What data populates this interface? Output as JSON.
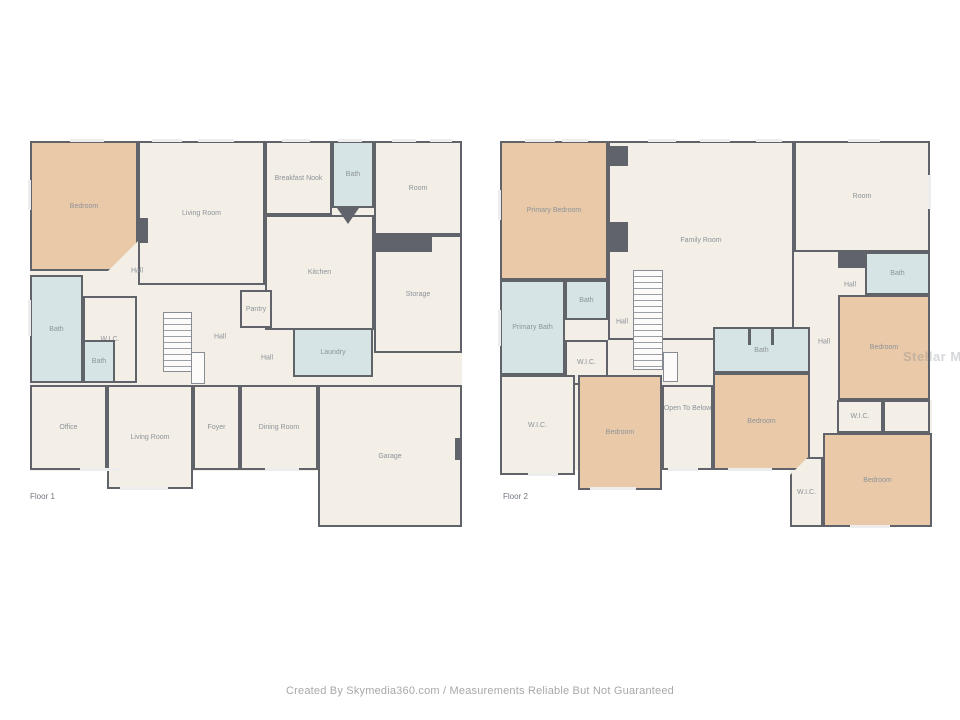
{
  "footer": {
    "credit": "Created By Skymedia360.com / Measurements Reliable But Not Guaranteed"
  },
  "watermark": {
    "text": "Stellar MLS"
  },
  "palette": {
    "floor": "#f3eee6",
    "bedroom": "#e9c9a7",
    "bath": "#d6e4e6",
    "wall": "#60646a",
    "label": "#8d939b",
    "window": "#ededed"
  },
  "floors": [
    {
      "label": "Floor 1",
      "label_pos": {
        "x": 30,
        "y": 492
      },
      "base": [
        {
          "x": 30,
          "y": 141,
          "w": 432,
          "h": 246
        },
        {
          "x": 30,
          "y": 385,
          "w": 288,
          "h": 86
        },
        {
          "x": 318,
          "y": 385,
          "w": 144,
          "h": 142
        }
      ],
      "rooms": [
        {
          "name": "Living Room",
          "type": "floor",
          "x": 138,
          "y": 141,
          "w": 127,
          "h": 144
        },
        {
          "name": "Breakfast Nook",
          "type": "floor",
          "x": 265,
          "y": 141,
          "w": 67,
          "h": 74
        },
        {
          "name": "Bath",
          "type": "bath",
          "x": 332,
          "y": 141,
          "w": 42,
          "h": 67
        },
        {
          "name": "Room",
          "type": "floor",
          "x": 374,
          "y": 141,
          "w": 88,
          "h": 94
        },
        {
          "name": "Hall",
          "type": "floor",
          "x": 332,
          "y": 208,
          "w": 42,
          "h": 44,
          "noborder": true
        },
        {
          "name": "Kitchen",
          "type": "floor",
          "x": 265,
          "y": 215,
          "w": 109,
          "h": 115
        },
        {
          "name": "Storage",
          "type": "floor",
          "x": 374,
          "y": 235,
          "w": 88,
          "h": 118
        },
        {
          "name": "Bedroom",
          "type": "bedroom",
          "x": 30,
          "y": 141,
          "w": 108,
          "h": 130,
          "clip": "br"
        },
        {
          "name": "Bath",
          "type": "bath",
          "x": 30,
          "y": 275,
          "w": 53,
          "h": 108
        },
        {
          "name": "W.I.C.",
          "type": "floor",
          "x": 83,
          "y": 296,
          "w": 54,
          "h": 87
        },
        {
          "name": "Bath",
          "type": "bath",
          "x": 83,
          "y": 340,
          "w": 32,
          "h": 43
        },
        {
          "name": "Pantry",
          "type": "floor",
          "x": 240,
          "y": 290,
          "w": 32,
          "h": 38
        },
        {
          "name": "Laundry",
          "type": "bath",
          "x": 293,
          "y": 328,
          "w": 80,
          "h": 49
        },
        {
          "name": "Office",
          "type": "floor",
          "x": 30,
          "y": 385,
          "w": 77,
          "h": 85
        },
        {
          "name": "Living Room",
          "type": "floor",
          "x": 107,
          "y": 385,
          "w": 86,
          "h": 104
        },
        {
          "name": "Foyer",
          "type": "floor",
          "x": 193,
          "y": 385,
          "w": 47,
          "h": 85
        },
        {
          "name": "Dining Room",
          "type": "floor",
          "x": 240,
          "y": 385,
          "w": 78,
          "h": 85
        },
        {
          "name": "Garage",
          "type": "floor",
          "x": 318,
          "y": 385,
          "w": 144,
          "h": 142
        }
      ],
      "labels": [
        {
          "text": "Hall",
          "x": 137,
          "y": 271
        },
        {
          "text": "Hall",
          "x": 220,
          "y": 337
        },
        {
          "text": "Hall",
          "x": 267,
          "y": 358
        }
      ],
      "wall_blocks": [
        {
          "x": 138,
          "y": 218,
          "w": 10,
          "h": 25
        },
        {
          "x": 374,
          "y": 237,
          "w": 58,
          "h": 15
        },
        {
          "x": 455,
          "y": 438,
          "w": 7,
          "h": 22
        },
        {
          "x": 337,
          "y": 208,
          "w": 22,
          "h": 16,
          "shape": "tri"
        }
      ],
      "stairs": [
        {
          "x": 163,
          "y": 312,
          "w": 29,
          "h": 60
        }
      ],
      "landings": [
        {
          "x": 191,
          "y": 352,
          "w": 14,
          "h": 32
        }
      ],
      "windows": [
        {
          "x": 70,
          "y": 139,
          "w": 34,
          "h": 3
        },
        {
          "x": 152,
          "y": 139,
          "w": 30,
          "h": 3
        },
        {
          "x": 198,
          "y": 139,
          "w": 36,
          "h": 3
        },
        {
          "x": 282,
          "y": 139,
          "w": 28,
          "h": 3
        },
        {
          "x": 338,
          "y": 139,
          "w": 24,
          "h": 3
        },
        {
          "x": 392,
          "y": 139,
          "w": 24,
          "h": 3
        },
        {
          "x": 430,
          "y": 139,
          "w": 22,
          "h": 3
        },
        {
          "x": 28,
          "y": 180,
          "w": 3,
          "h": 30
        },
        {
          "x": 28,
          "y": 300,
          "w": 3,
          "h": 36
        },
        {
          "x": 80,
          "y": 468,
          "w": 40,
          "h": 3
        },
        {
          "x": 120,
          "y": 487,
          "w": 48,
          "h": 3
        },
        {
          "x": 265,
          "y": 468,
          "w": 34,
          "h": 3
        }
      ]
    },
    {
      "label": "Floor 2",
      "label_pos": {
        "x": 503,
        "y": 492
      },
      "base": [
        {
          "x": 500,
          "y": 141,
          "w": 430,
          "h": 260
        },
        {
          "x": 500,
          "y": 400,
          "w": 310,
          "h": 70
        },
        {
          "x": 790,
          "y": 400,
          "w": 142,
          "h": 127
        }
      ],
      "rooms": [
        {
          "name": "Family Room",
          "type": "floor",
          "x": 608,
          "y": 141,
          "w": 186,
          "h": 199
        },
        {
          "name": "Primary Bedroom",
          "type": "bedroom",
          "x": 500,
          "y": 141,
          "w": 108,
          "h": 139
        },
        {
          "name": "Room",
          "type": "floor",
          "x": 794,
          "y": 141,
          "w": 136,
          "h": 111
        },
        {
          "name": "Bath",
          "type": "bath",
          "x": 865,
          "y": 252,
          "w": 65,
          "h": 43
        },
        {
          "name": "Bedroom",
          "type": "bedroom",
          "x": 838,
          "y": 295,
          "w": 92,
          "h": 105
        },
        {
          "name": "Bath",
          "type": "bath",
          "x": 565,
          "y": 280,
          "w": 43,
          "h": 40
        },
        {
          "name": "Primary Bath",
          "type": "bath",
          "x": 500,
          "y": 280,
          "w": 65,
          "h": 95
        },
        {
          "name": "W.I.C.",
          "type": "floor",
          "x": 565,
          "y": 340,
          "w": 43,
          "h": 45
        },
        {
          "name": "Bath",
          "type": "bath",
          "x": 713,
          "y": 327,
          "w": 97,
          "h": 46
        },
        {
          "name": "W.I.C.",
          "type": "floor",
          "x": 500,
          "y": 375,
          "w": 75,
          "h": 100
        },
        {
          "name": "Bedroom",
          "type": "bedroom",
          "x": 578,
          "y": 375,
          "w": 84,
          "h": 115
        },
        {
          "name": "Open To Below",
          "type": "floor",
          "x": 662,
          "y": 385,
          "w": 51,
          "h": 85,
          "labelTop": true
        },
        {
          "name": "Bedroom",
          "type": "bedroom",
          "x": 713,
          "y": 373,
          "w": 97,
          "h": 97
        },
        {
          "name": "W.I.C.",
          "type": "floor",
          "x": 837,
          "y": 400,
          "w": 46,
          "h": 33
        },
        {
          "name": "",
          "type": "floor",
          "x": 883,
          "y": 400,
          "w": 47,
          "h": 33
        },
        {
          "name": "Bedroom",
          "type": "bedroom",
          "x": 823,
          "y": 433,
          "w": 109,
          "h": 94
        },
        {
          "name": "W.I.C.",
          "type": "floor",
          "x": 790,
          "y": 457,
          "w": 33,
          "h": 70,
          "clip": "tl"
        }
      ],
      "labels": [
        {
          "text": "Hall",
          "x": 622,
          "y": 322
        },
        {
          "text": "Hall",
          "x": 850,
          "y": 285
        },
        {
          "text": "Hall",
          "x": 824,
          "y": 342
        }
      ],
      "wall_blocks": [
        {
          "x": 608,
          "y": 146,
          "w": 20,
          "h": 20
        },
        {
          "x": 608,
          "y": 222,
          "w": 20,
          "h": 30
        },
        {
          "x": 838,
          "y": 252,
          "w": 27,
          "h": 16
        },
        {
          "x": 748,
          "y": 329,
          "w": 3,
          "h": 16
        },
        {
          "x": 771,
          "y": 329,
          "w": 3,
          "h": 16
        }
      ],
      "stairs": [
        {
          "x": 633,
          "y": 270,
          "w": 30,
          "h": 100
        }
      ],
      "landings": [
        {
          "x": 663,
          "y": 352,
          "w": 15,
          "h": 30
        }
      ],
      "windows": [
        {
          "x": 525,
          "y": 139,
          "w": 30,
          "h": 3
        },
        {
          "x": 562,
          "y": 139,
          "w": 26,
          "h": 3
        },
        {
          "x": 648,
          "y": 139,
          "w": 28,
          "h": 3
        },
        {
          "x": 700,
          "y": 139,
          "w": 30,
          "h": 3
        },
        {
          "x": 756,
          "y": 139,
          "w": 26,
          "h": 3
        },
        {
          "x": 848,
          "y": 139,
          "w": 32,
          "h": 3
        },
        {
          "x": 498,
          "y": 190,
          "w": 3,
          "h": 30
        },
        {
          "x": 498,
          "y": 310,
          "w": 3,
          "h": 36
        },
        {
          "x": 928,
          "y": 175,
          "w": 3,
          "h": 34
        },
        {
          "x": 590,
          "y": 487,
          "w": 46,
          "h": 3
        },
        {
          "x": 668,
          "y": 468,
          "w": 30,
          "h": 3
        },
        {
          "x": 728,
          "y": 468,
          "w": 44,
          "h": 3
        },
        {
          "x": 850,
          "y": 525,
          "w": 40,
          "h": 3
        },
        {
          "x": 528,
          "y": 473,
          "w": 30,
          "h": 3
        }
      ]
    }
  ]
}
